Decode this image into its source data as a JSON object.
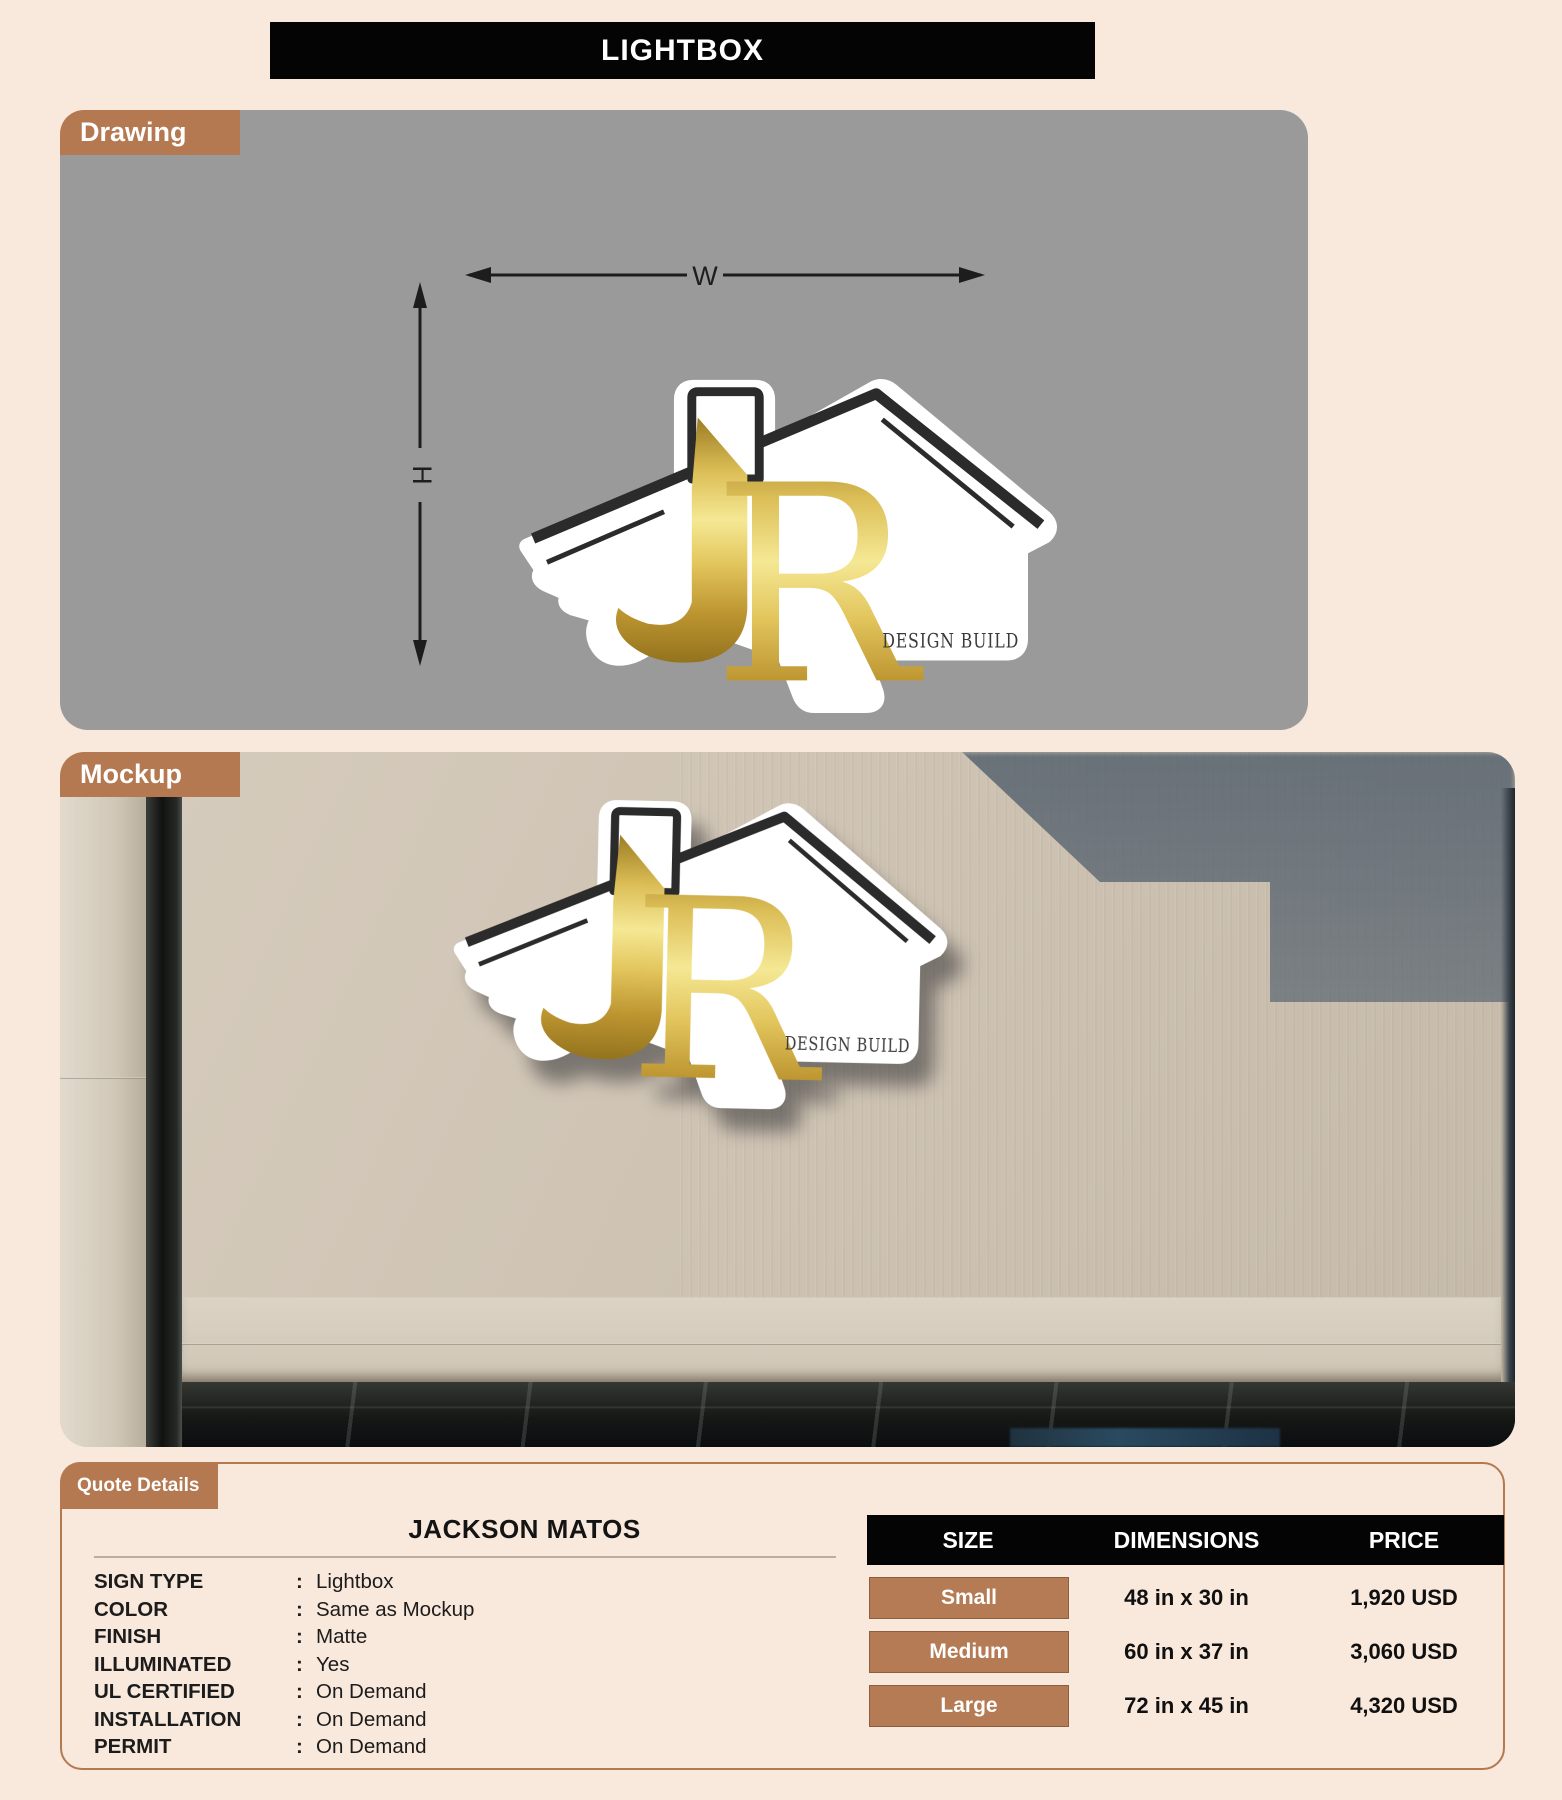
{
  "page": {
    "title": "LIGHTBOX"
  },
  "drawing": {
    "tab": "Drawing",
    "width_label": "W",
    "height_label": "H"
  },
  "mockup": {
    "tab": "Mockup"
  },
  "logo": {
    "monogram_j": "J",
    "monogram_r": "R",
    "wordmark": "DESIGN BUILD"
  },
  "quote": {
    "tab": "Quote Details",
    "customer": "JACKSON MATOS",
    "sep": ":",
    "specs": [
      {
        "label": "SIGN TYPE",
        "value": "Lightbox"
      },
      {
        "label": "COLOR",
        "value": "Same as Mockup"
      },
      {
        "label": "FINISH",
        "value": "Matte"
      },
      {
        "label": "ILLUMINATED",
        "value": "Yes"
      },
      {
        "label": "UL CERTIFIED",
        "value": "On Demand"
      },
      {
        "label": "INSTALLATION",
        "value": "On Demand"
      },
      {
        "label": "PERMIT",
        "value": "On Demand"
      }
    ],
    "pricing": {
      "columns": [
        "SIZE",
        "DIMENSIONS",
        "PRICE"
      ],
      "rows": [
        {
          "size": "Small",
          "dimensions": "48 in x 30 in",
          "price": "1,920 USD"
        },
        {
          "size": "Medium",
          "dimensions": "60 in x 37 in",
          "price": "3,060 USD"
        },
        {
          "size": "Large",
          "dimensions": "72 in x 45 in",
          "price": "4,320 USD"
        }
      ]
    }
  },
  "colors": {
    "page_bg": "#f9e8dc",
    "accent_tab": "#b57952",
    "header_bg": "#040404",
    "drawing_bg": "#9a9a9a",
    "logo_gold": "#d4af37",
    "logo_dark": "#2b2b2b"
  }
}
